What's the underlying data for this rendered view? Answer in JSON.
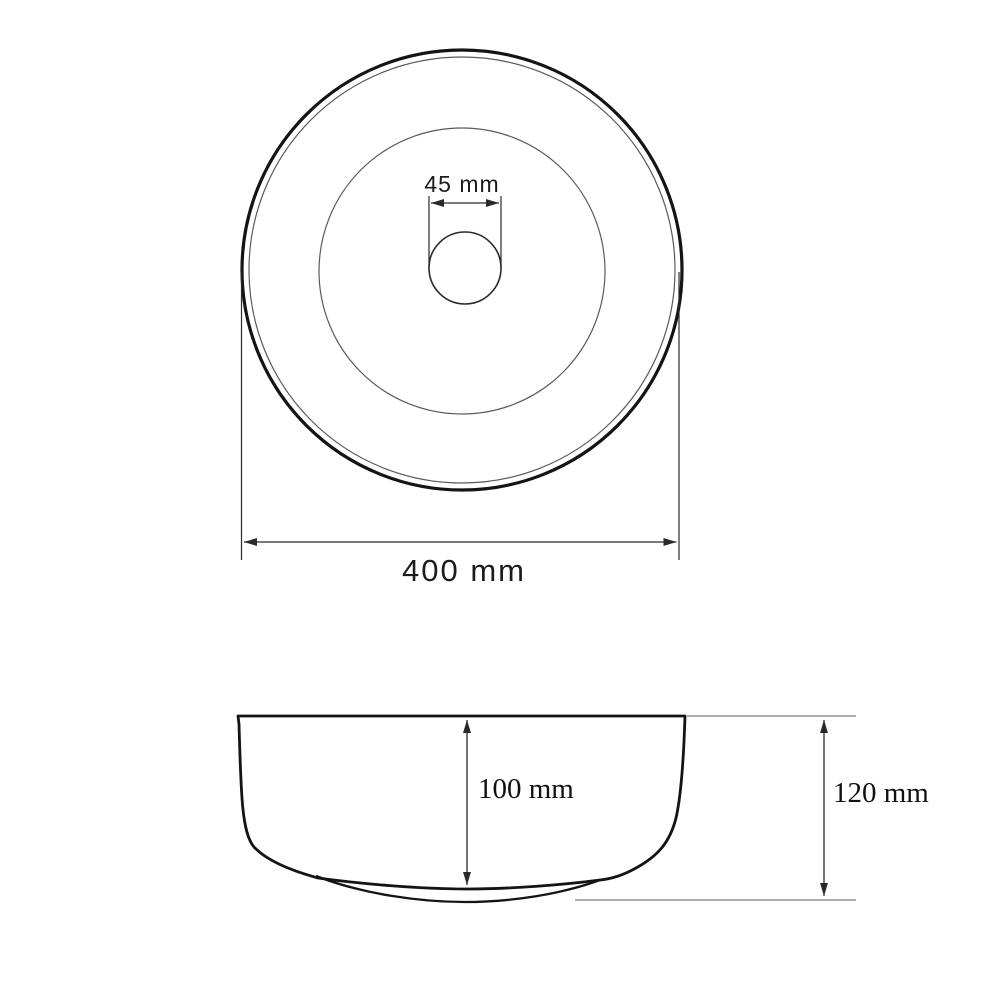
{
  "drawing": {
    "name": "round-countertop-basin-technical-drawing",
    "views": {
      "top": {
        "labels": {
          "drain_diameter": "45 mm",
          "outer_diameter": "400 mm"
        }
      },
      "side": {
        "labels": {
          "basin_depth": "100 mm",
          "total_height": "120 mm"
        }
      }
    },
    "dimensions_mm": {
      "outer_diameter": 400,
      "drain_diameter": 45,
      "basin_depth": 100,
      "total_height": 120
    },
    "colors": {
      "background": "#ffffff",
      "outline": "#141414",
      "thin_line": "#5a5a5a",
      "dimension_line": "#2a2a2a"
    }
  }
}
